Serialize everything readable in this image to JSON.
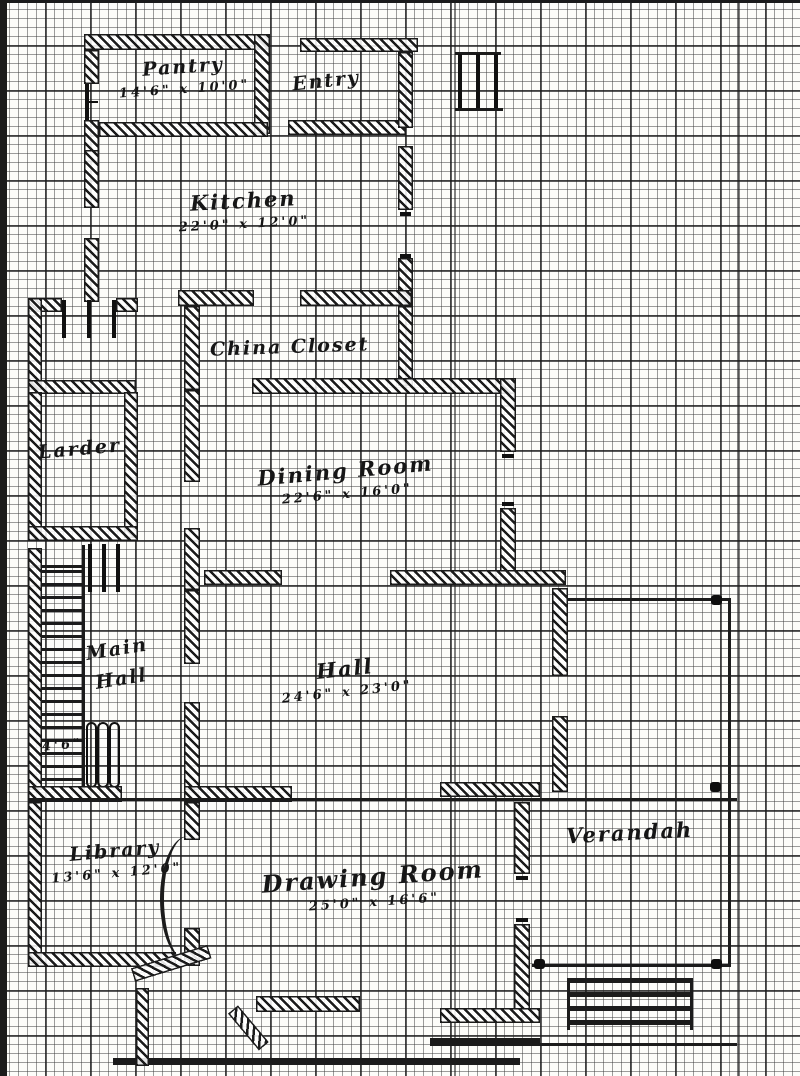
{
  "style": {
    "ink": "#161616",
    "paper": "#fdfdfa"
  },
  "rooms": {
    "pantry": {
      "name": "Pantry",
      "dims": "14'6\" x 10'0\""
    },
    "entry": {
      "name": "Entry"
    },
    "kitchen": {
      "name": "Kitchen",
      "dims": "22'0\" x 12'0\""
    },
    "china_closet": {
      "name": "China Closet"
    },
    "larder": {
      "name": "Larder"
    },
    "dining_room": {
      "name": "Dining Room",
      "dims": "22'6\" x 16'0\""
    },
    "main_hall": {
      "name_line1": "Main",
      "name_line2": "Hall"
    },
    "hall": {
      "name": "Hall",
      "dims": "24'6\" x 23'0\""
    },
    "library": {
      "name": "Library",
      "dims": "13'6\" x 12'0\""
    },
    "drawing_room": {
      "name": "Drawing Room",
      "dims": "25'0\" x 16'6\""
    },
    "verandah": {
      "name": "Verandah"
    }
  },
  "annotations": {
    "stair_width": "4'6\""
  }
}
